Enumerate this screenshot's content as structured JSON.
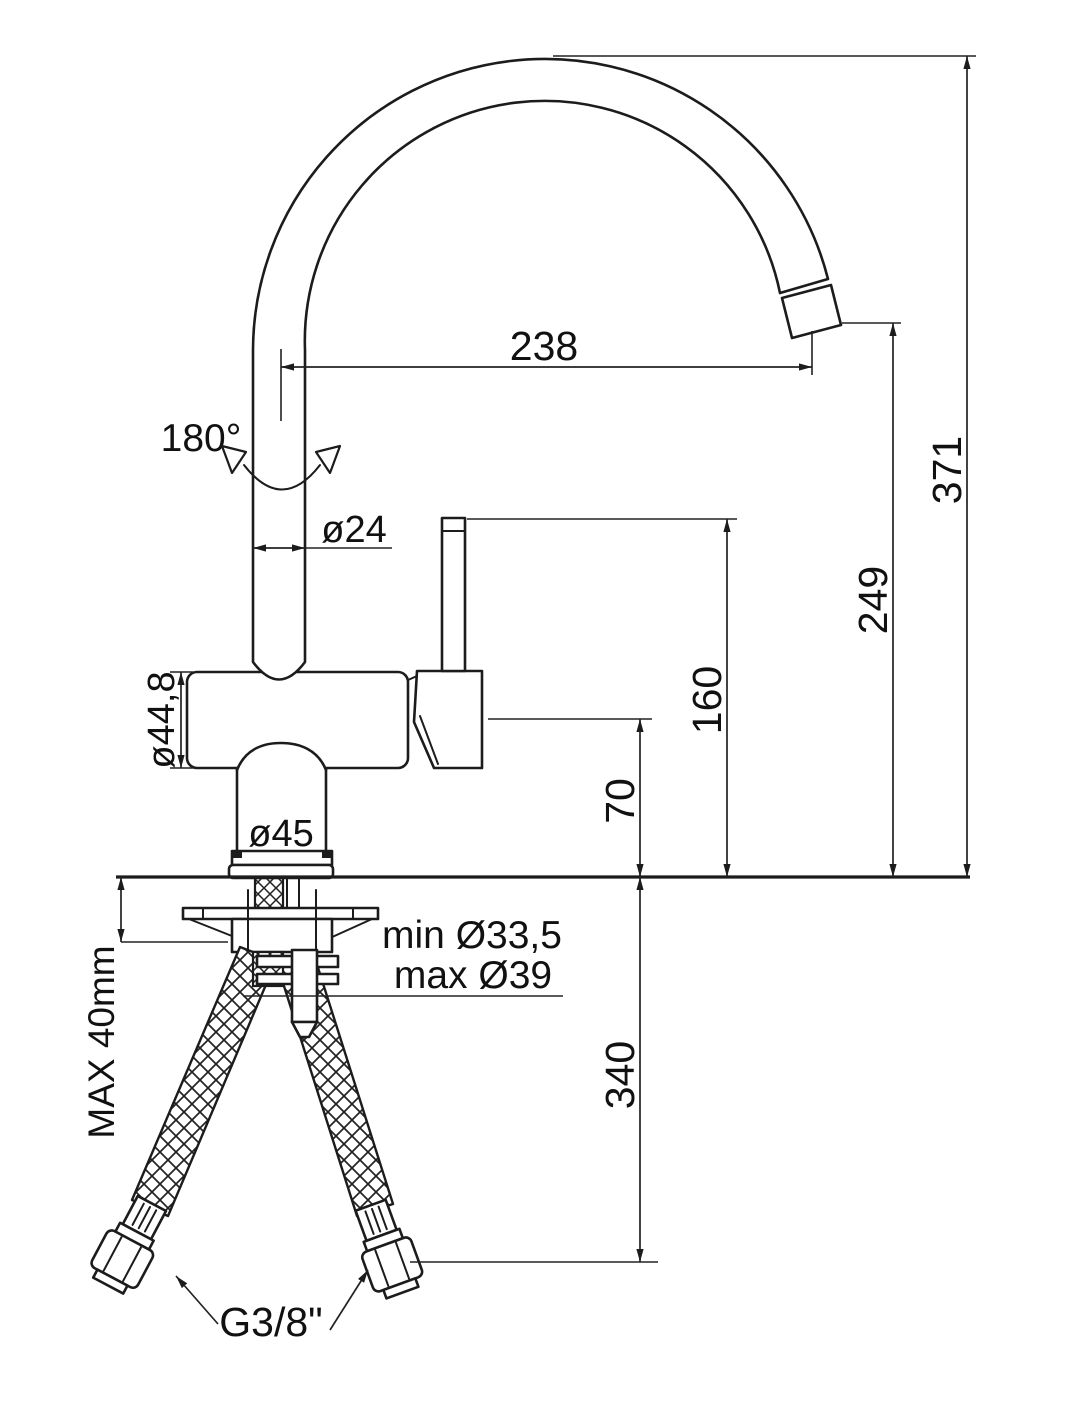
{
  "colors": {
    "line": "#1c1c1c",
    "background": "#ffffff"
  },
  "labels": {
    "reach": "238",
    "overall_height": "371",
    "outlet_height": "249",
    "lever_top_height": "160",
    "body_center_height": "70",
    "hose_drop": "340",
    "swivel_angle": "180°",
    "spout_diameter": "ø24",
    "body_diameter": "ø44,8",
    "base_diameter": "ø45",
    "hole_min": "min Ø33,5",
    "hole_max": "max Ø39",
    "deck_thickness_max": "MAX 40mm",
    "hose_thread": "G3/8\""
  }
}
